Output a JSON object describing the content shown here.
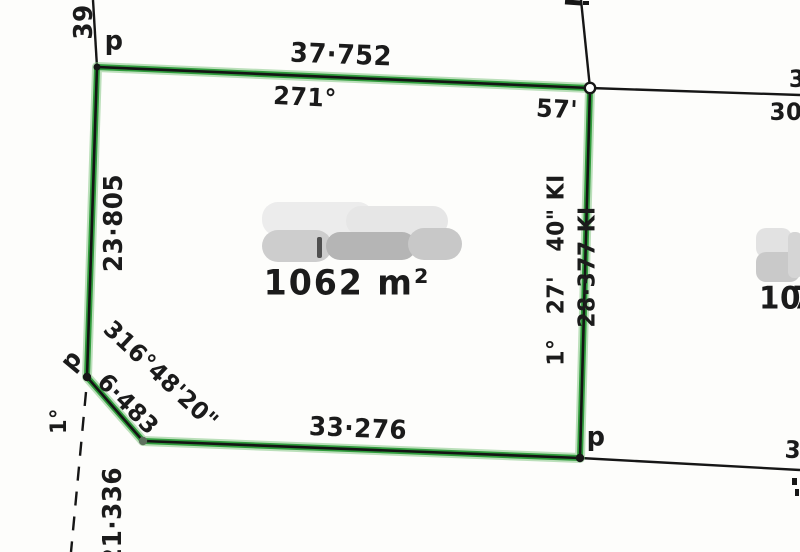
{
  "parcel": {
    "area_label": "1062 m²",
    "top_boundary": {
      "distance": "37·752",
      "bearing_deg": "271°",
      "bearing_min": "57'"
    },
    "left_boundary": {
      "distance": "23·805"
    },
    "splay_corner": {
      "bearing": "316°48'20\"",
      "distance": "6·483"
    },
    "bottom_boundary": {
      "distance": "33·276"
    },
    "right_boundary": {
      "bearing": "1°   27'   40\" KI",
      "distance": "28·377 KI"
    }
  },
  "dashed_line": {
    "bearing": "1°",
    "distance": "21·336"
  },
  "pegs": {
    "top_left": "p",
    "mid_left": "p",
    "bottom_right": "p"
  },
  "partial_labels": {
    "top_left_vertical": "39",
    "right_edge_top": "3",
    "right_edge_bearing": "30",
    "bottom_right_edge": "3",
    "adjacent_lot": "10",
    "adjacent_lot_cut": "7"
  },
  "colors": {
    "boundary_green": "#2f9c3c",
    "ink": "#1b1b1b"
  }
}
